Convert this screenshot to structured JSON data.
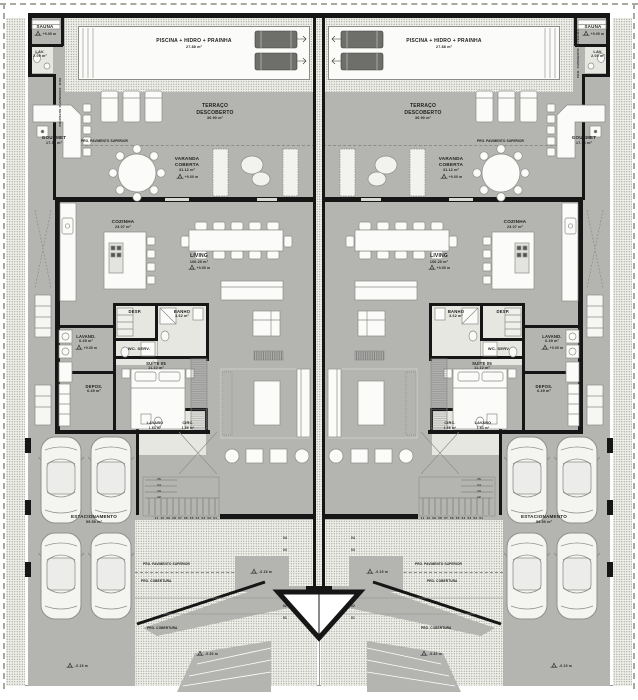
{
  "plan": {
    "rooms": {
      "sauna": {
        "name": "SAUNA"
      },
      "lav": {
        "name": "LAV.",
        "area": "2.00 m²"
      },
      "gourmet": {
        "name": "GOURMET",
        "area": "17.36 m²"
      },
      "piscina": {
        "name": "PISCINA + HIDRO + PRAINHA",
        "area": "27.88 m²"
      },
      "terraco": {
        "name": "TERRAÇO",
        "name2": "DESCOBERTO",
        "area": "36.90 m²"
      },
      "varanda": {
        "name": "VARANDA",
        "name2": "COBERTA",
        "area": "31.12 m²"
      },
      "cozinha": {
        "name": "COZINHA",
        "area": "23.07 m²"
      },
      "living": {
        "name": "LIVING",
        "area": "100.20 m²"
      },
      "desp": {
        "name": "DESP."
      },
      "banho": {
        "name": "BANHO",
        "area": "3.62 m²"
      },
      "lavand": {
        "name": "LAVAND.",
        "area": "6.49 m²"
      },
      "wcserv": {
        "name": "WC. SERV."
      },
      "suite05": {
        "name": "SUÍTE 05",
        "area": "11.22 m²"
      },
      "depos": {
        "name": "DEPOS.",
        "area": "6.49 m²"
      },
      "lavabo": {
        "name": "LAVABO",
        "area": "1.63 m²"
      },
      "circ": {
        "name": "CIRC.",
        "area": "1.66 m²"
      },
      "estacionamento": {
        "name": "ESTACIONAMENTO",
        "area": "59.50 m²"
      }
    },
    "annotations": {
      "proj_upper": "PRO. PAVIMENTO SUPERIOR",
      "proj_roof": "PRO. COBERTURA",
      "level_main": "+0.00 m",
      "level_low": "-0.15 m",
      "level_lower": "-0.30 m",
      "stair_run": "11 10 09 08 07 06 05 04 03 02 01",
      "stair_upper": [
        "15",
        "14",
        "13",
        "12"
      ],
      "ramp_steps": [
        "04",
        "03",
        "02",
        "01"
      ]
    },
    "colors": {
      "floor_gray": "#b4b4b1",
      "wall_black": "#161616",
      "stipple_base": "#eeeee8",
      "paper": "#ffffff"
    }
  }
}
